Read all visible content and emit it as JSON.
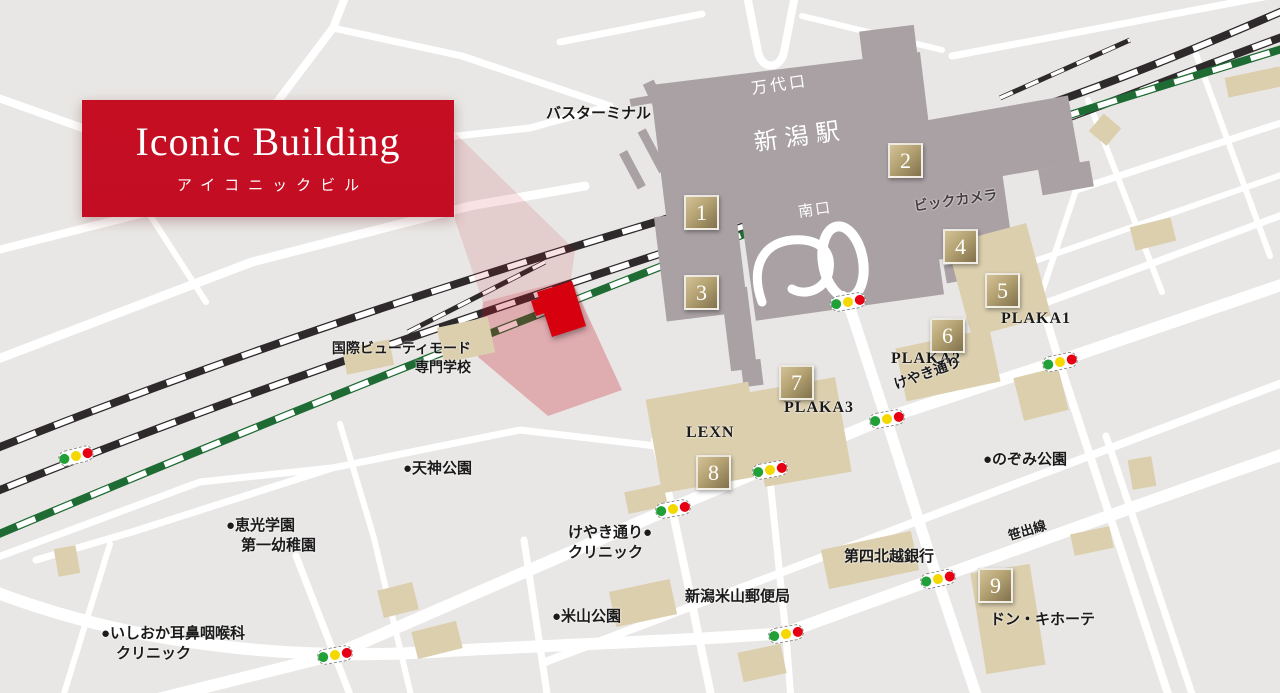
{
  "banner": {
    "title": "Iconic Building",
    "subtitle": "アイコニックビル"
  },
  "colors": {
    "accent_red": "#c30d23",
    "marker_red": "#d7000f",
    "highlight_pink": "rgba(197,13,35,0.27)",
    "beam_pink": "rgba(197,13,35,0.12)",
    "map_background": "#e9e7e5",
    "road_white": "#ffffff",
    "station_gray": "#a9a1a4",
    "building_tan": "#dccfae",
    "rail_black": "#2e2a2b",
    "rail_green": "#1e6b33",
    "signal_green": "#21a038",
    "signal_yellow": "#f5d800",
    "signal_red": "#e60012"
  },
  "badges": [
    {
      "n": "1",
      "x": 684,
      "y": 195
    },
    {
      "n": "2",
      "x": 888,
      "y": 143
    },
    {
      "n": "3",
      "x": 684,
      "y": 275
    },
    {
      "n": "4",
      "x": 943,
      "y": 229
    },
    {
      "n": "5",
      "x": 985,
      "y": 273
    },
    {
      "n": "6",
      "x": 930,
      "y": 318
    },
    {
      "n": "7",
      "x": 779,
      "y": 365
    },
    {
      "n": "8",
      "x": 696,
      "y": 455
    },
    {
      "n": "9",
      "x": 978,
      "y": 568
    }
  ],
  "traffic_lights": [
    {
      "x": 830,
      "y": 294,
      "r": -10
    },
    {
      "x": 1042,
      "y": 354,
      "r": -12
    },
    {
      "x": 869,
      "y": 411,
      "r": -10
    },
    {
      "x": 752,
      "y": 462,
      "r": -10
    },
    {
      "x": 655,
      "y": 501,
      "r": -10
    },
    {
      "x": 58,
      "y": 448,
      "r": -14
    },
    {
      "x": 317,
      "y": 647,
      "r": -10
    },
    {
      "x": 768,
      "y": 626,
      "r": -10
    },
    {
      "x": 920,
      "y": 571,
      "r": -12
    }
  ],
  "labels": [
    {
      "id": "bus-terminal",
      "text": "バスターミナル",
      "x": 546,
      "y": 104,
      "size": 15
    },
    {
      "id": "bandai-exit",
      "text": "万代口",
      "x": 750,
      "y": 79,
      "size": 16,
      "color": "#ffffff",
      "rotate": -8,
      "ls": 3,
      "white": true
    },
    {
      "id": "station-name",
      "text": "新潟駅",
      "x": 752,
      "y": 128,
      "size": 24,
      "color": "#ffffff",
      "rotate": -8,
      "ls": 7,
      "white": true
    },
    {
      "id": "south-exit",
      "text": "南口",
      "x": 797,
      "y": 203,
      "size": 15,
      "color": "#ffffff",
      "rotate": -8,
      "ls": 2,
      "white": true
    },
    {
      "id": "bic-camera",
      "text": "ビックカメラ",
      "x": 913,
      "y": 199,
      "size": 14,
      "color": "#453e40",
      "rotate": -8
    },
    {
      "id": "plaka1",
      "text": "PLAKA1",
      "x": 1001,
      "y": 308,
      "size": 16,
      "ls": 1
    },
    {
      "id": "plaka2",
      "text": "PLAKA2",
      "x": 891,
      "y": 348,
      "size": 16,
      "ls": 1
    },
    {
      "id": "plaka3",
      "text": "PLAKA3",
      "x": 784,
      "y": 397,
      "size": 16,
      "ls": 1
    },
    {
      "id": "lexn",
      "text": "LEXN",
      "x": 686,
      "y": 422,
      "size": 16,
      "ls": 1
    },
    {
      "id": "keyaki-street",
      "text": "けやき通り",
      "x": 892,
      "y": 378,
      "size": 14,
      "rotate": -20
    },
    {
      "id": "sasadashi-line",
      "text": "笹出線",
      "x": 1006,
      "y": 528,
      "size": 13,
      "rotate": -17
    },
    {
      "id": "nozomi-park",
      "text": "●のぞみ公園",
      "x": 983,
      "y": 450,
      "size": 15
    },
    {
      "id": "tenjin-park",
      "text": "●天神公園",
      "x": 403,
      "y": 459,
      "size": 15
    },
    {
      "id": "keiko-gakuen",
      "lines": [
        "●恵光学園",
        "　第一幼稚園"
      ],
      "x": 226,
      "y": 516,
      "size": 15
    },
    {
      "id": "ishioka-clinic",
      "lines": [
        "●いしおか耳鼻咽喉科",
        "　クリニック"
      ],
      "x": 101,
      "y": 624,
      "size": 15
    },
    {
      "id": "keyaki-clinic",
      "lines": [
        "けやき通り●",
        "クリニック"
      ],
      "x": 568,
      "y": 523,
      "size": 15
    },
    {
      "id": "yoneyama-park",
      "text": "●米山公園",
      "x": 552,
      "y": 607,
      "size": 15
    },
    {
      "id": "post-office",
      "text": "新潟米山郵便局",
      "x": 685,
      "y": 587,
      "size": 15
    },
    {
      "id": "daishi-bank",
      "text": "第四北越銀行",
      "x": 844,
      "y": 547,
      "size": 15
    },
    {
      "id": "don-quijote",
      "text": "ドン・キホーテ",
      "x": 990,
      "y": 610,
      "size": 15
    },
    {
      "id": "beauty-school",
      "lines": [
        "国際ビューティモード",
        "専門学校"
      ],
      "x": 303,
      "y": 341,
      "size": 14,
      "align": "right",
      "width": 168
    }
  ]
}
